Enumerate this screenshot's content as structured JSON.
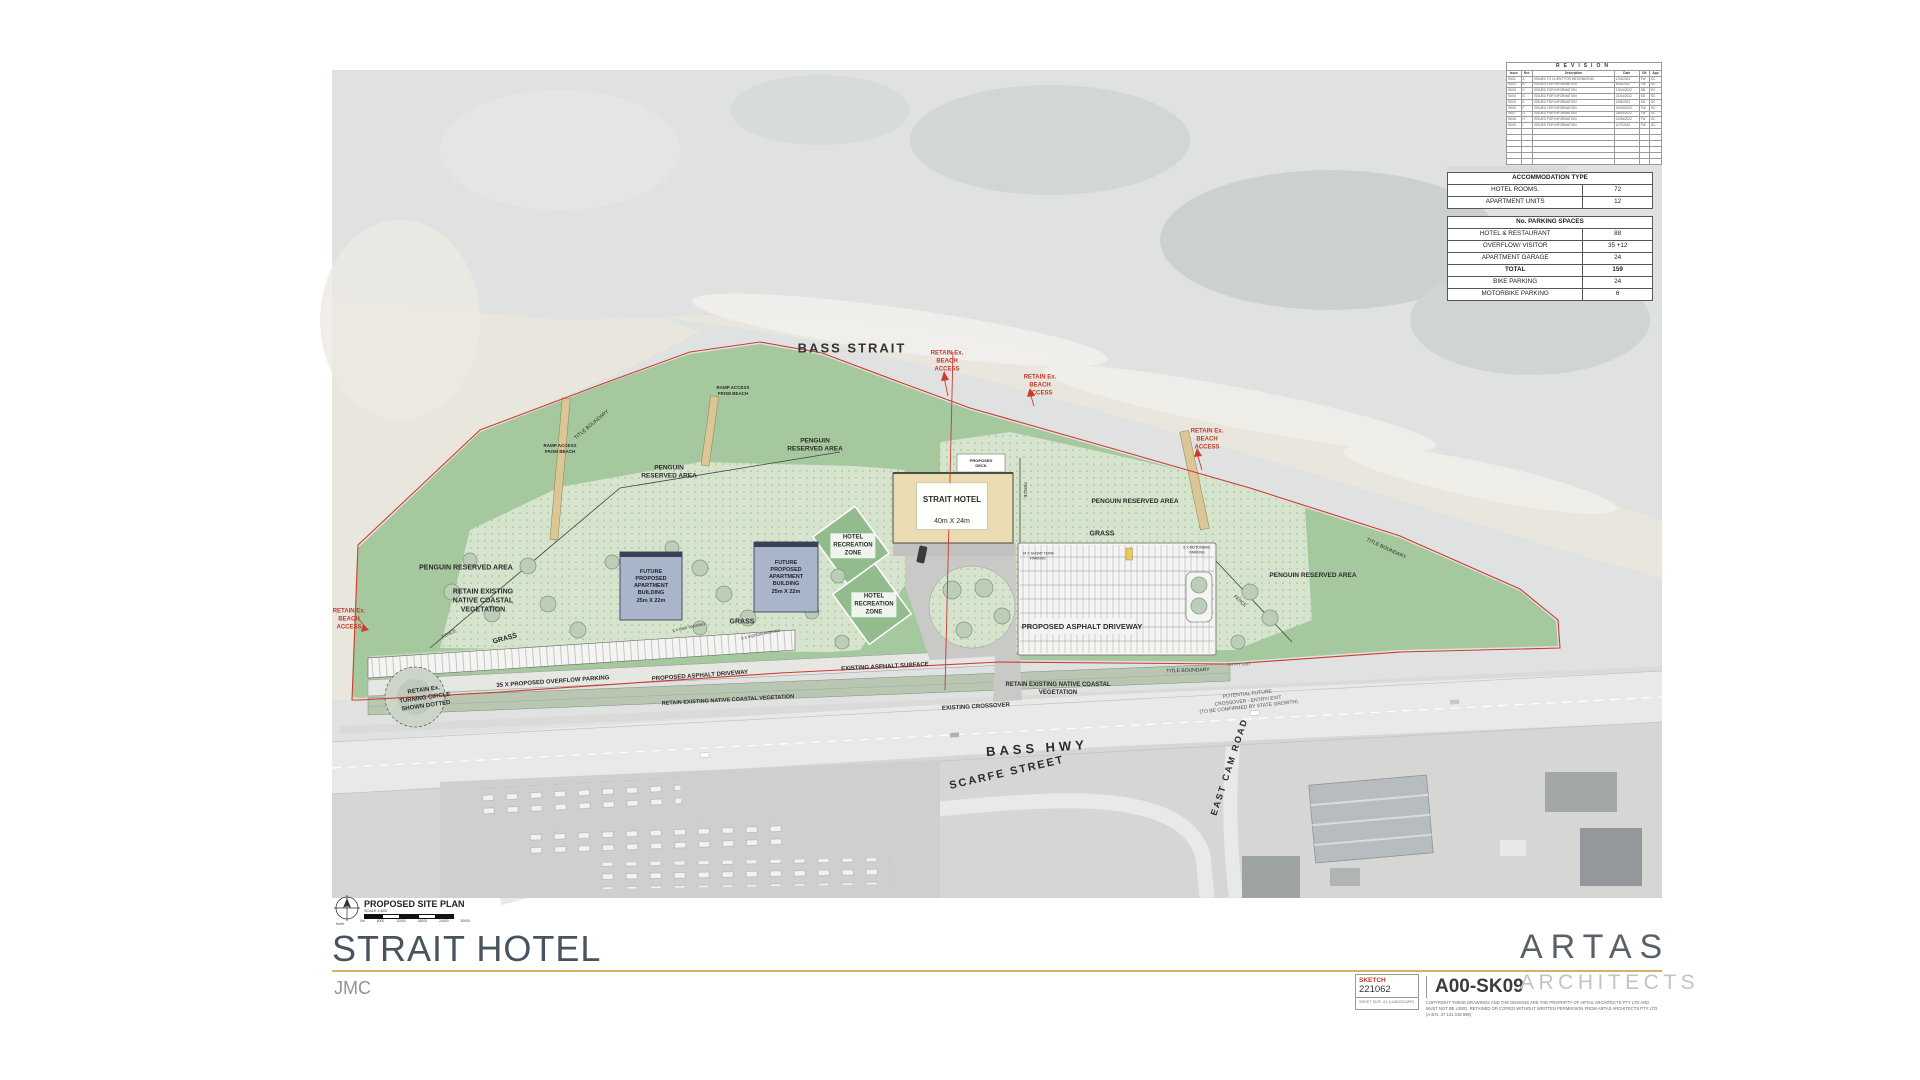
{
  "colors": {
    "accent_red": "#c0392b",
    "boundary_red": "#cc3b2f",
    "tan_line": "#d4b266",
    "title_gray": "#475460",
    "muted_gray": "#8d949b",
    "water": "#e0e2e2",
    "sand": "#e9e6dd",
    "green_main": "#a6c89e",
    "green_light": "#d6e4cd",
    "green_strip": "#b9c6b2",
    "road_gray": "#d6d7d5",
    "hotel_tan": "#eadcb0",
    "apartment_blue": "#a9b6c9",
    "rec_green": "#92bb8e",
    "tree_fill": "#bccdb9"
  },
  "revision_table": {
    "title": "REVISION",
    "headers": [
      "Issue",
      "Rev",
      "Description",
      "Date",
      "Dft",
      "App"
    ],
    "rows": [
      [
        "SK01",
        "A",
        "ISSUED TO CLIENT FOR INFORMATION",
        "1/04/2022",
        "TW",
        "SC"
      ],
      [
        "SK02",
        "B",
        "ISSUED FOR INFORMATION",
        "5/04/2022",
        "TW",
        "SC"
      ],
      [
        "SK03",
        "C",
        "ISSUED FOR INFORMATION",
        "13/04/2022",
        "SB",
        "SC"
      ],
      [
        "SK04",
        "D",
        "ISSUED FOR INFORMATION",
        "21/04/2022",
        "SD",
        "SC"
      ],
      [
        "SK05",
        "E",
        "ISSUED FOR INFORMATION",
        "2/05/2022",
        "SD",
        "SC"
      ],
      [
        "SK06",
        "F",
        "ISSUED FOR INFORMATION",
        "20/05/2022",
        "TW",
        "SC"
      ],
      [
        "SK07",
        "G",
        "ISSUED FOR INFORMATION",
        "25/05/2022",
        "TW",
        "SC"
      ],
      [
        "SK08",
        "H",
        "ISSUED FOR INFORMATION",
        "21/06/2022",
        "TW",
        "SC"
      ],
      [
        "SK09",
        "I",
        "ISSUED FOR INFORMATION",
        "1/07/2022",
        "TW",
        "SC"
      ]
    ],
    "empty_rows": 6
  },
  "accommodation_table": {
    "section1_title": "ACCOMMODATION TYPE",
    "rows1": [
      [
        "HOTEL ROOMS.",
        "72"
      ],
      [
        "APARTMENT UNITS",
        "12"
      ]
    ],
    "section2_title": "No. PARKING SPACES",
    "rows2": [
      [
        "HOTEL & RESTAURANT",
        "88"
      ],
      [
        "OVERFLOW/ VISITOR",
        "35 +12"
      ],
      [
        "APARTMENT GARAGE",
        "24"
      ],
      [
        "TOTAL",
        "159"
      ],
      [
        "BIKE PARKING",
        "24"
      ],
      [
        "MOTORBIKE PARKING",
        "6"
      ]
    ]
  },
  "plan": {
    "labels": {
      "bass_strait": "BASS STRAIT",
      "retain_beach_access": "RETAIN Ex.\nBEACH\nACCESS",
      "ramp_access": "RAMP ACCESS\nFROM BEACH",
      "penguin_1line": "PENGUIN RESERVED AREA",
      "penguin_2line": "PENGUIN\nRESERVED AREA",
      "retain_veg_3line": "RETAIN EXISTING\nNATIVE COASTAL\nVEGETATION",
      "grass": "GRASS",
      "future_apartment": "FUTURE\nPROPOSED\nAPARTMENT\nBUILDING\n25m X 22m",
      "hotel_name": "STRAIT HOTEL",
      "hotel_size": "40m X 24m",
      "proposed_deck": "PROPOSED\nDECK",
      "rec_zone": "HOTEL\nRECREATION\nZONE",
      "driveway": "PROPOSED ASPHALT DRIVEWAY",
      "overflow": "35 X PROPOSED OVERFLOW PARKING",
      "veg_1line": "RETAIN EXISTING NATIVE COASTAL VEGETATION",
      "veg_2line": "RETAIN EXISTING NATIVE COASTAL\nVEGETATION",
      "existing_asphalt": "EXISTING ASPHALT SURFACE",
      "title_boundary": "TITLE BOUNDARY",
      "fence": "FENCE",
      "existing_crossover": "EXISTING CROSSOVER",
      "bass_hwy": "BASS HWY",
      "potential_future": "POTENTIAL FUTURE\nCROSSOVER - ENTRY/ EXIT\n(TO BE CONFIRMED BY STATE GROWTH)",
      "entry_exit": "ENTRY    EXIT",
      "east_cam": "EAST CAM ROAD",
      "scarfe": "SCARFE STREET",
      "turning_circle": "RETAIN Ex.\nTURNING CIRCLE\nSHOWN DOTTED",
      "bike_parking": "6 X BIKE PARKING",
      "visitor_parking": "5 X VISITOR PARKING",
      "motorbike_parking": "6 X MOTORBIKE\nPARKING",
      "short_term_parking": "24 X SHORT TERM\nPARKING"
    }
  },
  "titleblock": {
    "plan_name": "PROPOSED SITE PLAN",
    "scale": "SCALE 1:600",
    "scale_ticks": [
      "0m",
      "6000",
      "12000",
      "18000",
      "24000",
      "30000"
    ],
    "north_label": "North",
    "project_title": "STRAIT HOTEL",
    "client": "JMC",
    "sketch_label": "SKETCH",
    "job_number": "221062",
    "sheet_size": "SHEET SIZE: A1 (LANDSCAPE)",
    "drawing_number": "A00-SK09",
    "firm_name": "ARTAS",
    "firm_type": "ARCHITECTS",
    "copyright": "COPYRIGHT THESE DRAWINGS AND THE DESIGNS ARE THE PROPERTY OF ARTAS ARCHITECTS PTY LTD AND MUST NOT BE USED, RETAINED OR COPIED WITHOUT WRITTEN PERMISSION FROM ARTAS ARCHITECTS PTY LTD. (A.B.N. 37 131 018 998)"
  }
}
